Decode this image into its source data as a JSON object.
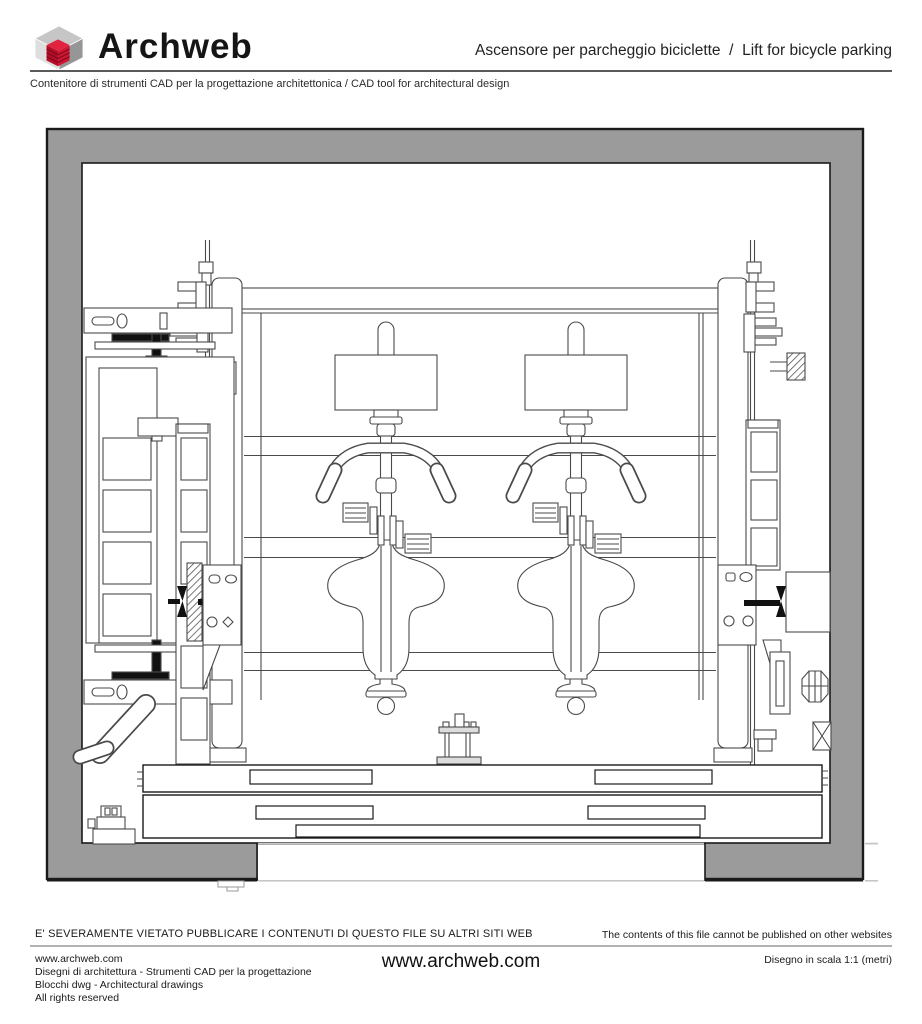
{
  "header": {
    "brand": "Archweb",
    "title": "Ascensore per parcheggio biciclette  /  Lift for bicycle parking",
    "subtitle": "Contenitore di strumenti CAD per la progettazione architettonica / CAD tool for architectural design",
    "logo_icon": "archweb-cube-logo-icon"
  },
  "drawing": {
    "content": "technical CAD front elevation of a two-bicycle parking lift inside a concrete shaft",
    "colors": {
      "wall_gray": "#9b9b9b",
      "outline_dark": "#1a1a1a",
      "cad_line": "#4a4a4a",
      "ground_line": "#c6c6c6"
    }
  },
  "footer": {
    "warning_it": "E' SEVERAMENTE VIETATO PUBBLICARE I CONTENUTI DI QUESTO FILE SU ALTRI SITI WEB",
    "warning_en": "The contents of this file cannot be published on other websites",
    "info": {
      "url": "www.archweb.com",
      "line2": "Disegni di architettura - Strumenti CAD  per la progettazione",
      "line3": "Blocchi dwg - Architectural drawings",
      "line4": "All rights reserved"
    },
    "center_url": "www.archweb.com",
    "scale_note": "Disegno in scala 1:1 (metri)"
  },
  "colors": {
    "accent_red": "#c8102e",
    "rule_dark": "#5a5a5a",
    "rule_light": "#b3b3b3"
  }
}
